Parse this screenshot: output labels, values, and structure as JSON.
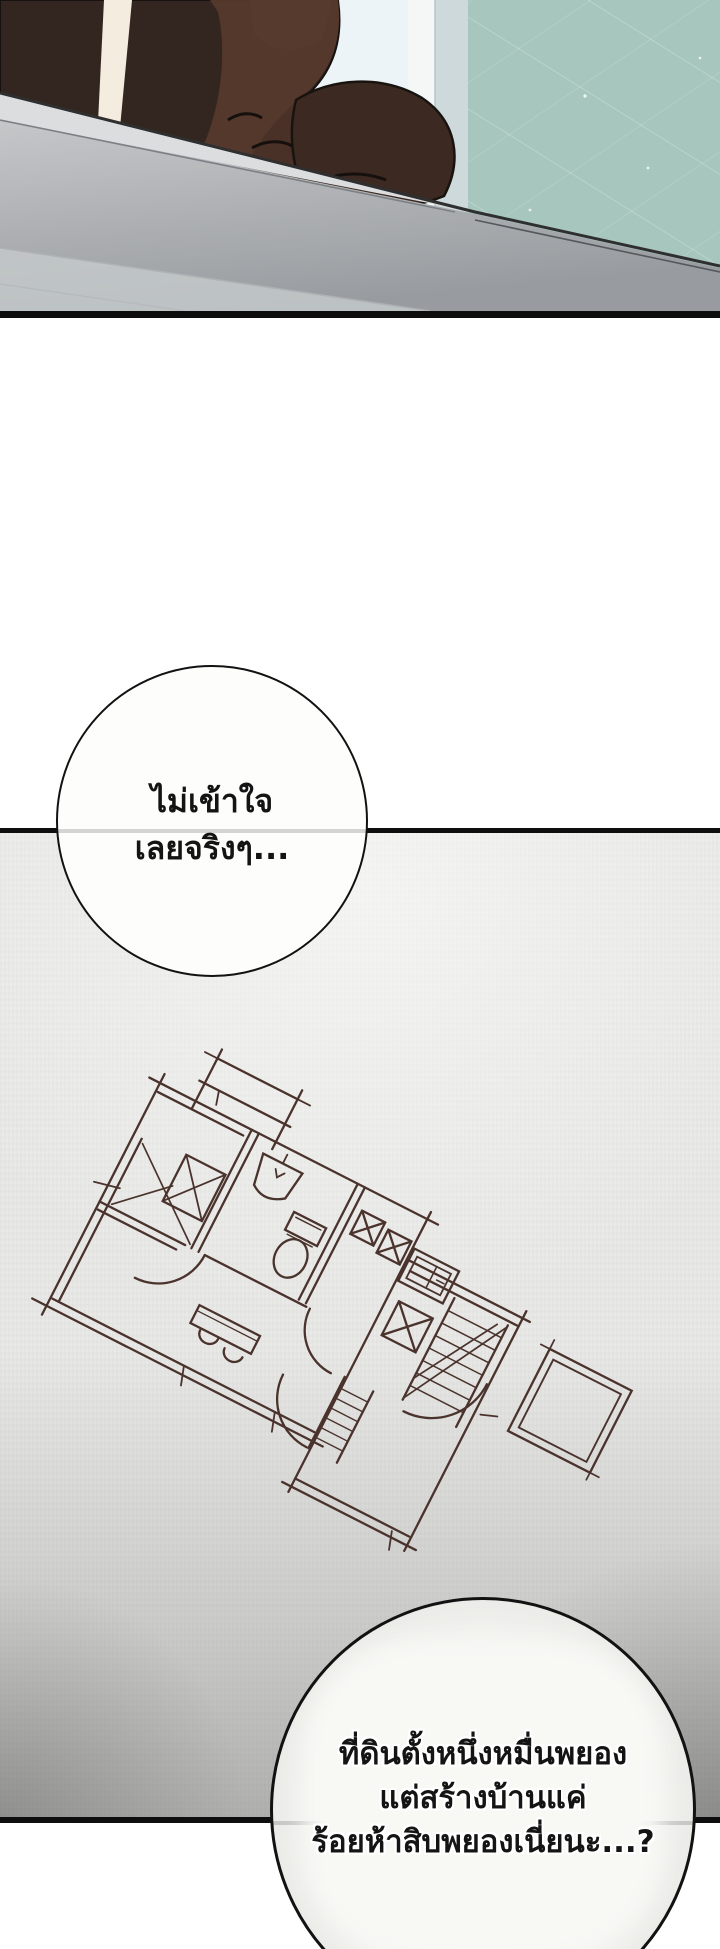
{
  "page": {
    "width_px": 720,
    "height_px": 1949,
    "background": "#ffffff"
  },
  "panel_rooftop": {
    "label": "rooftop-scene",
    "colors": {
      "sky": "#edf4f8",
      "building_glass": "#a6c6be",
      "building_edge_strip": "#f5f7f6",
      "building_side_face": "#cdd9da",
      "figure_dark": "#33251f",
      "figure_suit": "#56392c",
      "ledge_top": "#c7c8ca",
      "ledge_face": "#9a9ea2",
      "panel_border": "#0d0d0d"
    }
  },
  "panel_floorplan": {
    "label": "floorplan-sketch",
    "colors": {
      "paper": "#e9e9e7",
      "ink": "#4a332c",
      "panel_border": "#0e0e0e"
    },
    "rotation_deg": 27,
    "elements": [
      "outer-walls",
      "annex-ticked-box",
      "closet-x-boxes",
      "bathroom-sink",
      "toilet",
      "kitchen-counter-x",
      "stove-unit",
      "staircase-hatched",
      "lower-stair-strip",
      "door-swing-arcs",
      "table-with-chairs",
      "side-room-square",
      "dimension-ticks"
    ]
  },
  "speech_bubbles": [
    {
      "name": "bubble-top",
      "lines": [
        "ไม่เข้าใจ",
        "เลยจริงๆ..."
      ]
    },
    {
      "name": "bubble-bottom",
      "lines": [
        "ที่ดินตั้งหนึ่งหมื่นพยอง",
        "แต่สร้างบ้านแค่",
        "ร้อยห้าสิบพยองเนี่ยนะ...?"
      ]
    }
  ]
}
